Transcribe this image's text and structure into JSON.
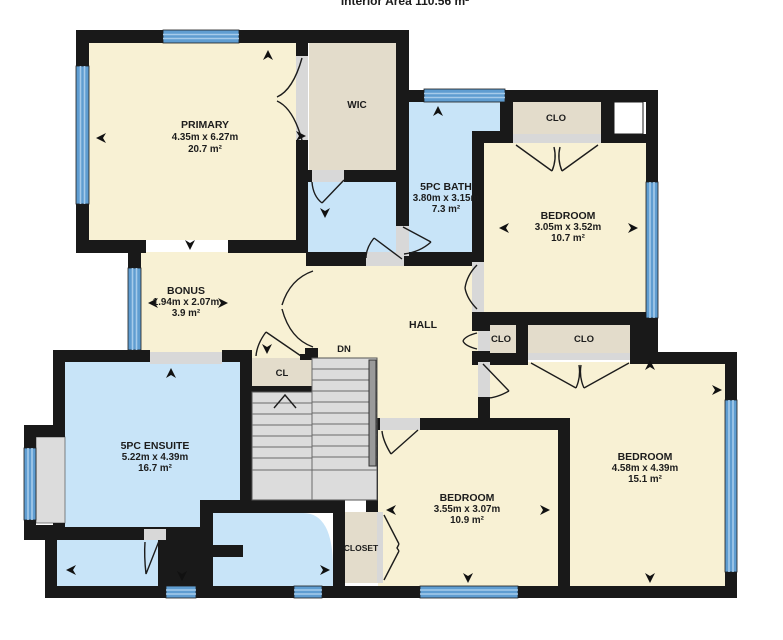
{
  "header": {
    "interior_area": "Interior Area 110.56 m²"
  },
  "colors": {
    "room_cream": "#F8F1D4",
    "room_blue": "#C8E4F8",
    "closet_tan": "#E3DCCB",
    "stair_gray": "#DCDCDC",
    "wall_black": "#191919",
    "window_blue": "#5F9DD1",
    "threshold_gray": "#D8D8D8"
  },
  "rooms": {
    "primary": {
      "name": "PRIMARY",
      "dims": "4.35m x 6.27m",
      "area": "20.7 m²"
    },
    "wic": {
      "name": "WIC"
    },
    "bath": {
      "name": "5PC BATH",
      "dims": "3.80m x 3.15m",
      "area": "7.3 m²"
    },
    "closet_top": {
      "name": "CLO"
    },
    "bedroom_ne": {
      "name": "BEDROOM",
      "dims": "3.05m x 3.52m",
      "area": "10.7 m²"
    },
    "bonus": {
      "name": "BONUS",
      "dims": "1.94m x 2.07m",
      "area": "3.9 m²"
    },
    "hall": {
      "name": "HALL"
    },
    "stairs": {
      "label": "DN"
    },
    "closet_hall": {
      "name": "CL"
    },
    "closet_mid_small": {
      "name": "CLO"
    },
    "closet_mid_large": {
      "name": "CLO"
    },
    "ensuite": {
      "name": "5PC ENSUITE",
      "dims": "5.22m x 4.39m",
      "area": "16.7 m²"
    },
    "bedroom_south": {
      "name": "BEDROOM",
      "dims": "3.55m x 3.07m",
      "area": "10.9 m²"
    },
    "bedroom_se": {
      "name": "BEDROOM",
      "dims": "4.58m x 4.39m",
      "area": "15.1 m²"
    },
    "closet_south": {
      "name": "CLOSET"
    }
  }
}
